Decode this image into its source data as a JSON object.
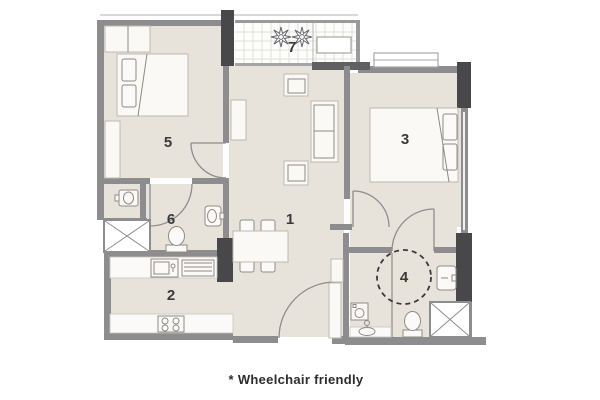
{
  "caption": "* Wheelchair friendly",
  "plan": {
    "type": "apartment-floor-plan",
    "wheelchair_friendly": true,
    "rooms": [
      {
        "number": "1",
        "fixtures": [
          "sofa",
          "armchair",
          "armchair",
          "tv-console",
          "dining-table",
          "four-chairs",
          "entrance-door"
        ]
      },
      {
        "number": "2",
        "fixtures": [
          "kitchen-counter",
          "sink",
          "drying-rack",
          "cooktop"
        ]
      },
      {
        "number": "3",
        "fixtures": [
          "double-bed",
          "window",
          "door"
        ]
      },
      {
        "number": "4",
        "fixtures": [
          "toilet",
          "washbasin",
          "washbasin",
          "washing-machine",
          "wheelchair-turning-circle",
          "door"
        ]
      },
      {
        "number": "5",
        "fixtures": [
          "double-bed",
          "wardrobe",
          "shelf",
          "door"
        ]
      },
      {
        "number": "6",
        "fixtures": [
          "toilet",
          "washbasin",
          "washbasin",
          "door"
        ]
      },
      {
        "number": "7",
        "fixtures": [
          "plant",
          "plant",
          "planter",
          "tiled-floor"
        ]
      }
    ],
    "shafts": 2
  },
  "colors": {
    "background": "#ffffff",
    "floor": "#e8e3da",
    "wall": "#8d8d8f",
    "column": "#48484a",
    "balcony_floor": "#fdfdfc",
    "label_text": "#3a3a3c",
    "caption_text": "#2c2c2e"
  }
}
